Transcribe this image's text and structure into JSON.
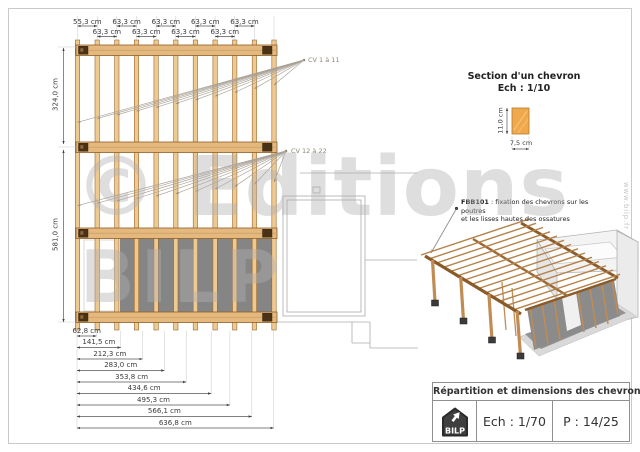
{
  "watermark": {
    "line1": "© Editions",
    "line2": "BILP",
    "site_vertical": "www.bilp.fr"
  },
  "plan": {
    "top_dims_row1": [
      "55,3 cm",
      "63,3 cm",
      "63,3 cm",
      "63,3 cm",
      "63,3 cm"
    ],
    "top_dims_row2": [
      "63,3 cm",
      "63,3 cm",
      "63,3 cm",
      "63,3 cm"
    ],
    "left_dims": [
      "324,0 cm",
      "581,0 cm"
    ],
    "cascade_dims": [
      "62,8 cm",
      "141,5 cm",
      "212,3 cm",
      "283,0 cm",
      "353,8 cm",
      "434,6 cm",
      "495,3 cm",
      "566,1 cm",
      "636,8 cm"
    ],
    "callout_top": "CV 1 à 11",
    "callout_mid": "CV 12 à 22"
  },
  "section": {
    "title_line1": "Section d'un chevron",
    "title_line2": "Ech : 1/10",
    "height_dim": "11,0 cm",
    "width_dim": "7,5 cm"
  },
  "note": {
    "code": "FBB101",
    "line1_rest": " : fixation des chevrons sur les poutres",
    "line2": "et les lisses hautes des ossatures"
  },
  "title_block": {
    "title": "Répartition et dimensions des chevrons",
    "scale": "Ech : 1/70",
    "page": "P : 14/25",
    "logo_text": "BILP"
  },
  "colors": {
    "wood_fill": "#EEC990",
    "wood_edge": "#9A6A33",
    "beam_fill": "#E5B87E",
    "connector_dark": "#4A3216",
    "panel_gray": "#858585",
    "section_wood": "#F0A84C",
    "dim_line": "#555555",
    "watermark_gray": "rgba(176,176,176,0.42)",
    "logo_bg": "#3F3F3F"
  }
}
